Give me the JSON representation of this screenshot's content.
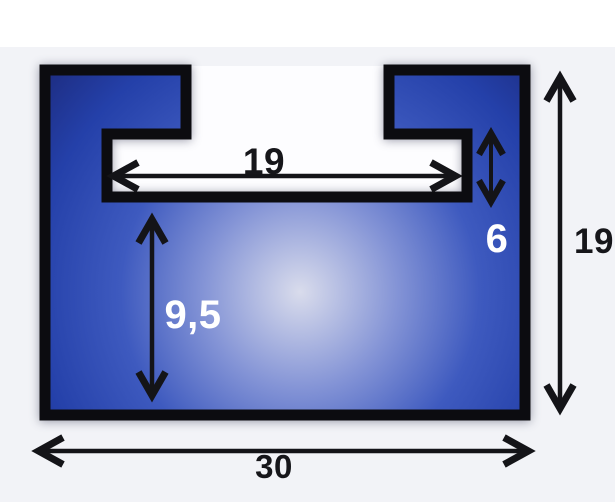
{
  "page": {
    "background": "#f2f3f7",
    "top_band_color": "#ffffff"
  },
  "diagram": {
    "kind": "t-slot-slide-profile-cross-section",
    "shape_colors": {
      "outline": "#0c0c10",
      "body_center": "#d9dcec",
      "body_mid": "#3e5abf",
      "body_edge": "#1c2a7c",
      "cavity": "#fdfdff",
      "arrow": "#141418"
    },
    "dimensions": [
      {
        "name": "slot-inner-width",
        "label": "19",
        "orientation": "horizontal",
        "label_color": "#16161a"
      },
      {
        "name": "lip-notch-height",
        "label": "6",
        "orientation": "vertical",
        "label_color": "#ffffff"
      },
      {
        "name": "lower-body-depth",
        "label": "9,5",
        "orientation": "vertical",
        "label_color": "#ffffff"
      },
      {
        "name": "overall-height",
        "label": "19",
        "orientation": "vertical",
        "label_color": "#16161a"
      },
      {
        "name": "overall-width",
        "label": "30",
        "orientation": "horizontal",
        "label_color": "#16161a"
      }
    ]
  }
}
